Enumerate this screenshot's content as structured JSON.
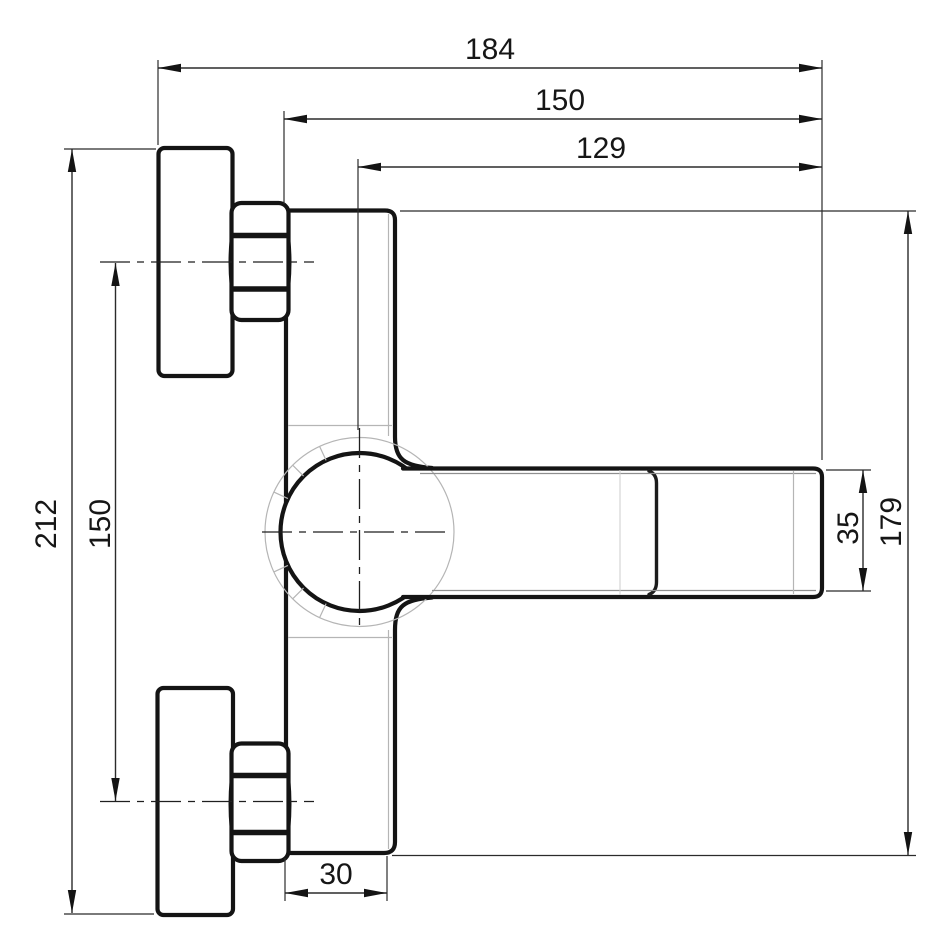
{
  "drawing": {
    "subject": "Wall-mounted single-lever mixer tap - side elevation with dimensions",
    "colors": {
      "outline": "#141414",
      "construction": "#b5b5b5",
      "background": "#ffffff"
    },
    "dims": {
      "overall_width": "184",
      "face_to_spout": "150",
      "center_to_spout": "129",
      "overall_height": "212",
      "inlet_spacing": "150",
      "spout_height": "35",
      "body_height": "179",
      "base_depth": "30"
    }
  }
}
